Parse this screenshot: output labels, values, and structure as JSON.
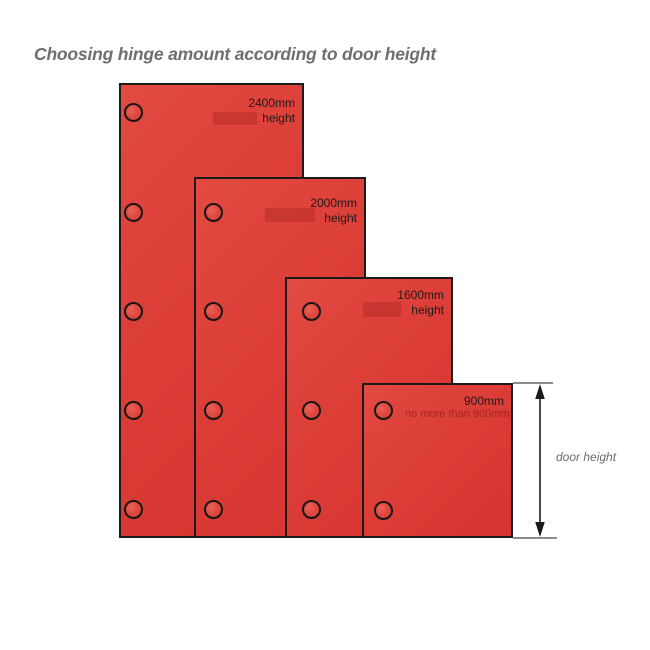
{
  "title": "Choosing hinge amount according to door height",
  "diagram": {
    "dimension_label": "door height",
    "doors": [
      {
        "height_label": "2400mm",
        "sub_label": "height",
        "hinge_count": 5,
        "x": 119,
        "y": 83,
        "w": 185,
        "h": 455,
        "label_y": 96,
        "hinge_cx": 133,
        "hinge_cys": [
          112,
          212,
          311,
          410,
          509
        ],
        "ghost": {
          "x": 213,
          "y": 112,
          "w": 44,
          "h": 13,
          "text": ""
        }
      },
      {
        "height_label": "2000mm",
        "sub_label": "height",
        "hinge_count": 4,
        "x": 194,
        "y": 177,
        "w": 172,
        "h": 361,
        "label_y": 196,
        "hinge_cx": 213,
        "hinge_cys": [
          212,
          311,
          410,
          509
        ],
        "ghost": {
          "x": 265,
          "y": 208,
          "w": 50,
          "h": 14,
          "text": ""
        }
      },
      {
        "height_label": "1600mm",
        "sub_label": "height",
        "hinge_count": 3,
        "x": 285,
        "y": 277,
        "w": 168,
        "h": 261,
        "label_y": 288,
        "hinge_cx": 311,
        "hinge_cys": [
          311,
          410,
          509
        ],
        "ghost": {
          "x": 363,
          "y": 302,
          "w": 38,
          "h": 15,
          "text": ""
        }
      },
      {
        "height_label": "900mm",
        "sub_label": "",
        "hinge_count": 2,
        "x": 362,
        "y": 383,
        "w": 151,
        "h": 155,
        "label_y": 394,
        "hinge_cx": 383,
        "hinge_cys": [
          410,
          510
        ],
        "ghost": {
          "x": 405,
          "y": 407,
          "w": 103,
          "h": 14,
          "text": "no more than 900mm"
        }
      }
    ]
  },
  "colors": {
    "door_fill": "#dc3d37",
    "door_fill_highlight": "#e24a41",
    "door_border": "#1b1b1b",
    "label_text": "#1a1a1a",
    "ghost_red": "#a8221f",
    "title_gray": "#6e6e6e",
    "dimension_gray": "#6a6a6a",
    "background": "#ffffff"
  }
}
